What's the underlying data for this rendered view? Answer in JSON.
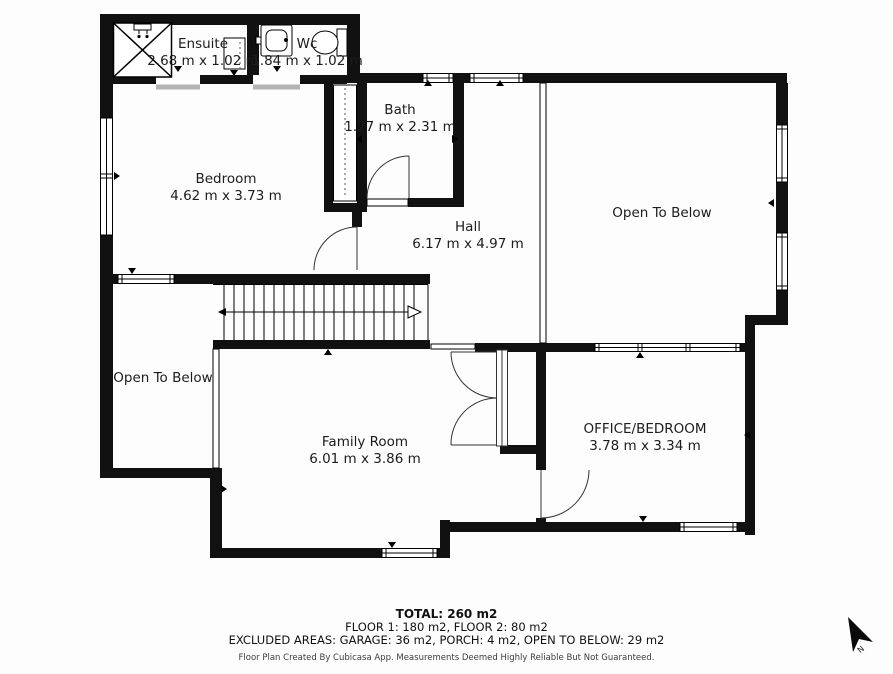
{
  "rooms": [
    {
      "name": "Ensuite",
      "dims": "2.68 m x 1.02 m"
    },
    {
      "name": "Wc",
      "dims": "1.84 m x 1.02 m"
    },
    {
      "name": "Bath",
      "dims": "1.77 m x 2.31 m"
    },
    {
      "name": "Bedroom",
      "dims": "4.62 m x 3.73 m"
    },
    {
      "name": "Hall",
      "dims": "6.17 m x 4.97 m"
    },
    {
      "name": "Open To Below",
      "dims": ""
    },
    {
      "name": "Open To Below",
      "dims": ""
    },
    {
      "name": "Family Room",
      "dims": "6.01 m x 3.86 m"
    },
    {
      "name": "OFFICE/BEDROOM",
      "dims": "3.78 m x 3.34 m"
    }
  ],
  "summary": {
    "total": "TOTAL: 260 m2",
    "floors": "FLOOR 1: 180 m2, FLOOR 2: 80 m2",
    "excluded": "EXCLUDED AREAS: GARAGE: 36 m2, PORCH: 4 m2, OPEN TO BELOW: 29 m2",
    "credit": "Floor Plan Created By Cubicasa App. Measurements Deemed Highly Reliable But Not Guaranteed."
  },
  "compass": {
    "north_label": "N"
  },
  "colors": {
    "wall": "#111111",
    "threshold_grey": "#b3b3b3",
    "background": "#fdfdfd"
  }
}
